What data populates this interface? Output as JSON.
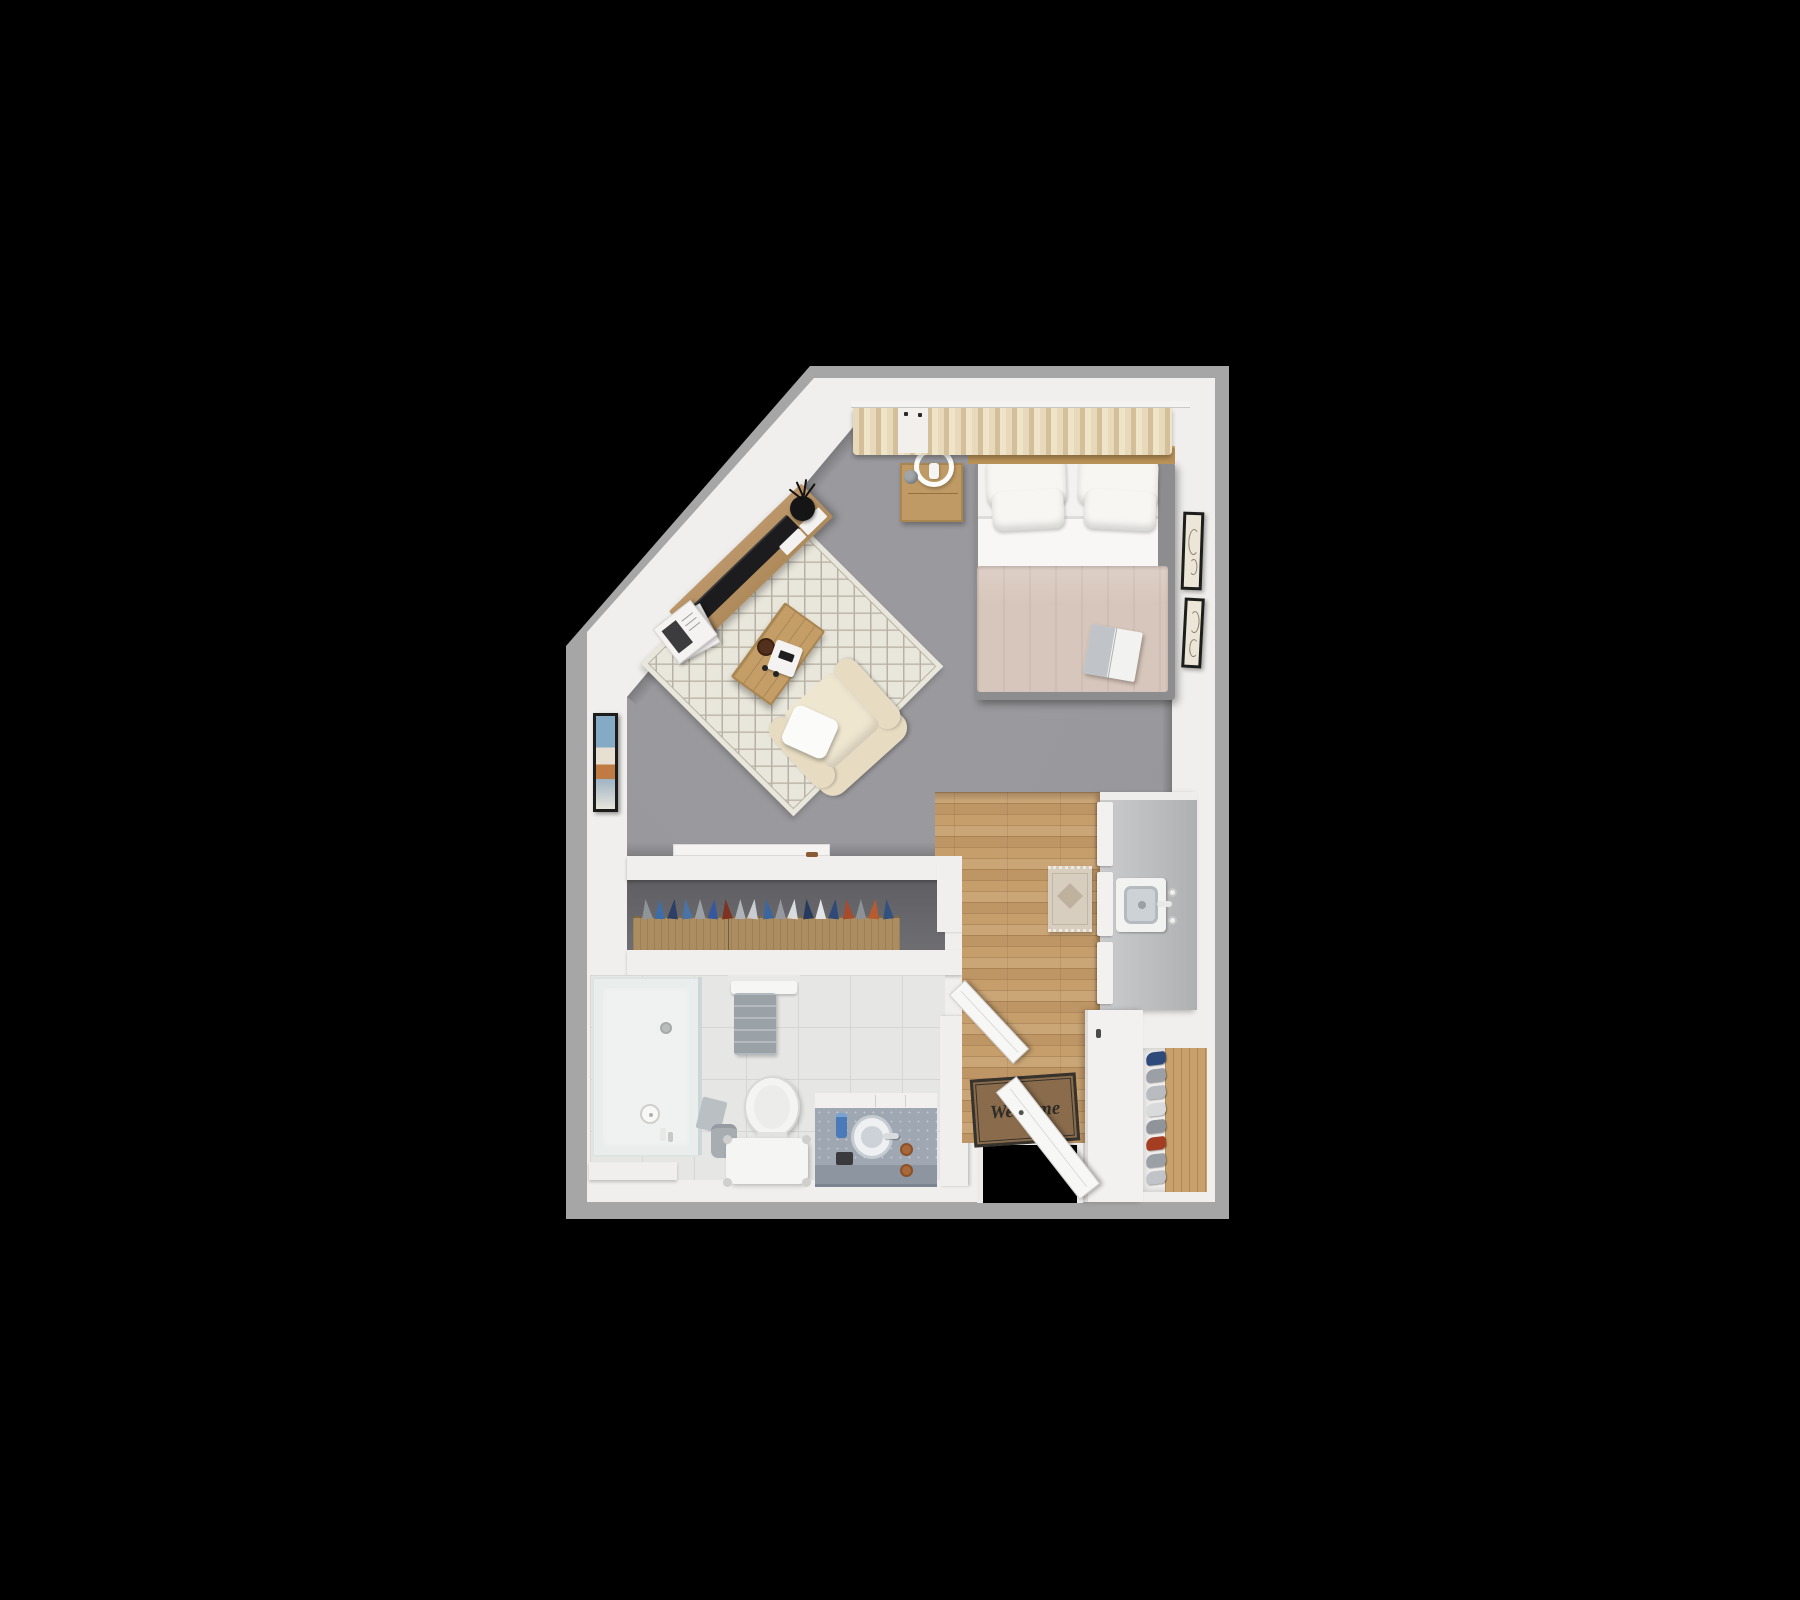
{
  "scene": {
    "title": "studio-apartment-floor-plan",
    "description": "Top-down 3D render of a furnished studio apartment floor plan on a black background",
    "rooms": [
      "living-bedroom",
      "closet-corridor",
      "bathroom",
      "kitchen-entry"
    ]
  },
  "entry": {
    "welcome_mat": {
      "line1": "Welcome",
      "line2": "HOME"
    }
  },
  "closet": {
    "clothes_colors": [
      "#8f9499",
      "#3e6ea5",
      "#2c3f66",
      "#4a74a8",
      "#9aa0a4",
      "#35599c",
      "#7e3322",
      "#b0b4b8",
      "#c9cdd1",
      "#3c66a0",
      "#96999d",
      "#d9dbdd",
      "#273a5e",
      "#e3e4e6",
      "#2f4a78",
      "#a84a2c",
      "#8e9296",
      "#b85c30",
      "#33517e"
    ]
  },
  "shoe_rack": {
    "shoe_colors": [
      "#2e4a7a",
      "#9aa0a6",
      "#b8bcc0",
      "#d8dadc",
      "#8e9499",
      "#a53d22",
      "#9aa0a6",
      "#c0c4c8"
    ]
  },
  "furniture_visible": [
    "double-bed",
    "nightstand",
    "ring-lamp",
    "curtains",
    "tv-console",
    "tv",
    "plant",
    "magazines",
    "area-rug",
    "coffee-table",
    "armchair",
    "wardrobe-dresser",
    "shower",
    "toilet",
    "stool",
    "vanity-sink",
    "kitchen-counter",
    "kitchen-sink",
    "runner-rug",
    "welcome-mat",
    "front-door",
    "shoe-rack",
    "wall-art"
  ],
  "colors": {
    "background": "#000000",
    "wall": "#f0efed",
    "wall_shadow": "#a6a6a6",
    "carpet": "#96969a",
    "carpet_dark": "#88888c",
    "rug_base": "#e9e6db",
    "rug_line": "#b7b2a5",
    "wood_floor": "#c69e6c",
    "closet_floor": "#6e6e72",
    "dresser_wood": "#ab8d61",
    "tile": "#e6e6e4",
    "tile_line": "#d6d6d4",
    "counter": "#babbbd",
    "sink_basin": "#ccd2d6",
    "duvet": "#d7c6bb",
    "sheet": "#f8f7f5",
    "pillow": "#f7f6f3",
    "bed_frame": "#8d8d8f",
    "headboard": "#b99259",
    "nightstand": "#bf9a64",
    "curtain": "#e7d9ba",
    "curtain_dark": "#d3bf9a",
    "armchair": "#e7dcc2",
    "armchair_seat": "#efe6d0",
    "coffee_table": "#c49e66",
    "console": "#ae8a5b",
    "tv": "#1c1c1e",
    "mat": "#8a6c4c",
    "mat_border": "#36322c",
    "niche_wood": "#c7a06c",
    "shoe_niche_bg": "#efeeec",
    "marble": "#9fa8b2",
    "marble_front": "#8c95a0",
    "door": "#f7f7f5",
    "frame_border": "#1d1d1b",
    "art_paper": "#ece6d8",
    "towel": "#9aa2a8",
    "bin": "#a7adb1",
    "lamp": "#fcfcfa",
    "bowl": "#53301d",
    "runner": "#d8cec0",
    "runner_pattern": "#b3a691"
  }
}
